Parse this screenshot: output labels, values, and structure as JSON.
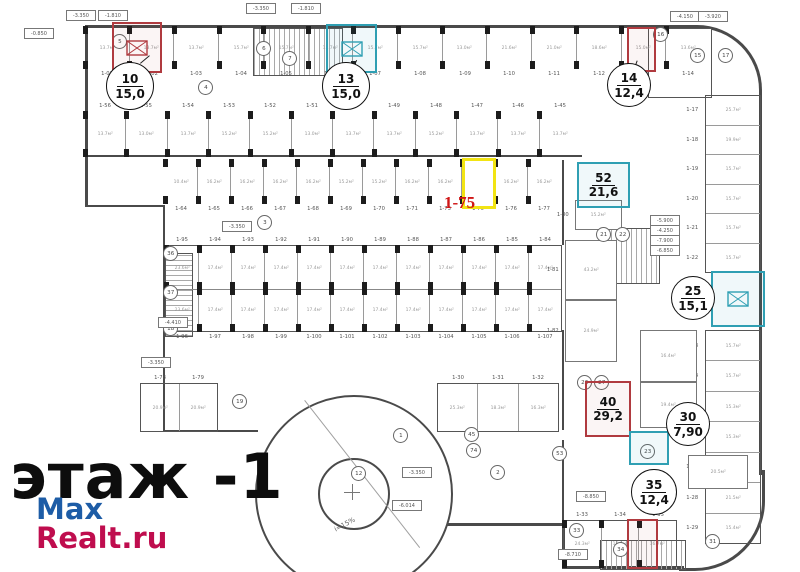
{
  "floor_label": "этаж -1",
  "watermark": {
    "line1": "Max",
    "line2": "Realt.ru",
    "color1": "#1d5ca6",
    "color2": "#bf0d4e"
  },
  "selected_unit": {
    "code": "1-75",
    "highlight_color": "#f2e413",
    "label_color": "#d01616"
  },
  "badges": {
    "u10": {
      "num": "10",
      "area": "15,0",
      "accent": "#b03a3f"
    },
    "u13": {
      "num": "13",
      "area": "15,0",
      "accent": "#2f9fb3"
    },
    "u14": {
      "num": "14",
      "area": "12,4",
      "accent": "#b03a3f"
    },
    "u52": {
      "num": "52",
      "area": "21,6",
      "accent": "#2f9fb3"
    },
    "u25": {
      "num": "25",
      "area": "15,1",
      "accent": "#2f9fb3"
    },
    "u40": {
      "num": "40",
      "area": "29,2",
      "accent": "#b03a3f"
    },
    "u30": {
      "num": "30",
      "area": "7,90",
      "accent": "#2f9fb3"
    },
    "u35": {
      "num": "35",
      "area": "12,4",
      "accent": "#b03a3f"
    }
  },
  "rows": {
    "rowA": [
      {
        "n": "1-01",
        "a": "13.7м²"
      },
      {
        "n": "1-02",
        "a": "13.7м²"
      },
      {
        "n": "1-03",
        "a": "13.7м²"
      },
      {
        "n": "1-04",
        "a": "15.7м²"
      },
      {
        "n": "1-05",
        "a": "15.7м²"
      },
      {
        "n": "1-06",
        "a": "15.7м²"
      },
      {
        "n": "1-07",
        "a": "15.7м²"
      },
      {
        "n": "1-08",
        "a": "15.7м²"
      },
      {
        "n": "1-09",
        "a": "13.0м²"
      },
      {
        "n": "1-10",
        "a": "21.6м²"
      },
      {
        "n": "1-11",
        "a": "21.0м²"
      },
      {
        "n": "1-12",
        "a": "18.6м²"
      },
      {
        "n": "1-13",
        "a": "15.0м²"
      },
      {
        "n": "1-14",
        "a": "13.6м²"
      }
    ],
    "rowB": [
      {
        "n": "1-56",
        "a": "13.7м²"
      },
      {
        "n": "1-55",
        "a": "13.0м²"
      },
      {
        "n": "1-54",
        "a": "13.7м²"
      },
      {
        "n": "1-53",
        "a": "15.2м²"
      },
      {
        "n": "1-52",
        "a": "15.2м²"
      },
      {
        "n": "1-51",
        "a": "13.0м²"
      },
      {
        "n": "1-50",
        "a": "13.7м²"
      },
      {
        "n": "1-49",
        "a": "13.7м²"
      },
      {
        "n": "1-48",
        "a": "15.2м²"
      },
      {
        "n": "1-47",
        "a": "13.7м²"
      },
      {
        "n": "1-46",
        "a": "13.7м²"
      },
      {
        "n": "1-45",
        "a": "13.7м²"
      }
    ],
    "rowC": [
      {
        "n": "1-64",
        "a": "10.4м²"
      },
      {
        "n": "1-65",
        "a": "16.2м²"
      },
      {
        "n": "1-66",
        "a": "16.2м²"
      },
      {
        "n": "1-67",
        "a": "16.2м²"
      },
      {
        "n": "1-68",
        "a": "16.2м²"
      },
      {
        "n": "1-69",
        "a": "15.2м²"
      },
      {
        "n": "1-70",
        "a": "15.2м²"
      },
      {
        "n": "1-71",
        "a": "16.2м²"
      },
      {
        "n": "1-73",
        "a": "16.2м²"
      },
      {
        "n": "1-75",
        "a": ""
      },
      {
        "n": "1-76",
        "a": "16.2м²"
      },
      {
        "n": "1-77",
        "a": "16.2м²"
      }
    ],
    "centralTop": [
      {
        "n": "1-95",
        "a": "23.6м²"
      },
      {
        "n": "1-94",
        "a": "17.4м²"
      },
      {
        "n": "1-93",
        "a": "17.4м²"
      },
      {
        "n": "1-92",
        "a": "17.4м²"
      },
      {
        "n": "1-91",
        "a": "17.4м²"
      },
      {
        "n": "1-90",
        "a": "17.4м²"
      },
      {
        "n": "1-89",
        "a": "17.4м²"
      },
      {
        "n": "1-88",
        "a": "17.4м²"
      },
      {
        "n": "1-87",
        "a": "17.4м²"
      },
      {
        "n": "1-86",
        "a": "17.4м²"
      },
      {
        "n": "1-85",
        "a": "17.4м²"
      },
      {
        "n": "1-84",
        "a": "17.4м²"
      }
    ],
    "centralBottom": [
      {
        "n": "1-96",
        "a": "23.6м²"
      },
      {
        "n": "1-97",
        "a": "17.4м²"
      },
      {
        "n": "1-98",
        "a": "17.4м²"
      },
      {
        "n": "1-99",
        "a": "17.4м²"
      },
      {
        "n": "1-100",
        "a": "17.4м²"
      },
      {
        "n": "1-101",
        "a": "17.4м²"
      },
      {
        "n": "1-102",
        "a": "17.4м²"
      },
      {
        "n": "1-103",
        "a": "17.4м²"
      },
      {
        "n": "1-104",
        "a": "17.4м²"
      },
      {
        "n": "1-105",
        "a": "17.4м²"
      },
      {
        "n": "1-106",
        "a": "17.4м²"
      },
      {
        "n": "1-107",
        "a": "17.4м²"
      }
    ],
    "rightUpper": [
      {
        "n": "1-17",
        "a": "25.7м²"
      },
      {
        "n": "1-18",
        "a": "19.9м²"
      },
      {
        "n": "1-19",
        "a": "15.7м²"
      },
      {
        "n": "1-20",
        "a": "15.7м²"
      },
      {
        "n": "1-21",
        "a": "15.7м²"
      },
      {
        "n": "1-22",
        "a": "15.7м²"
      }
    ],
    "rightLower": [
      {
        "n": "1-23",
        "a": "15.7м²"
      },
      {
        "n": "1-24",
        "a": "15.7м²"
      },
      {
        "n": "1-25",
        "a": "15.3м²"
      },
      {
        "n": "1-26",
        "a": "15.3м²"
      },
      {
        "n": "1-27",
        "a": "15.3м²"
      },
      {
        "n": "1-28",
        "a": "21.5м²"
      },
      {
        "n": "1-29",
        "a": "15.4м²"
      }
    ],
    "bottomRow": [
      {
        "n": "1-33",
        "a": "24.3м²"
      },
      {
        "n": "1-34",
        "a": "15.9м²"
      },
      {
        "n": "1-35",
        "a": "16.7м²"
      }
    ],
    "leftPair": [
      {
        "n": "1-78",
        "a": "20.9м²"
      },
      {
        "n": "1-79",
        "a": "20.9м²"
      }
    ],
    "circleTopRow": [
      {
        "n": "1-30",
        "a": "25.3м²"
      },
      {
        "n": "1-31",
        "a": "18.3м²"
      },
      {
        "n": "1-32",
        "a": "16.3м²"
      }
    ]
  },
  "misc_rooms": [
    {
      "n": "1-80",
      "a": "15.2м²"
    },
    {
      "n": "1-81",
      "a": "43.2м²"
    },
    {
      "n": "1-82",
      "a": "24.9м²"
    },
    {
      "n": "",
      "a": "16.4м²"
    },
    {
      "n": "",
      "a": "19.4м²"
    },
    {
      "n": "",
      "a": "14.4м²"
    },
    {
      "n": "",
      "a": "20.5м²"
    }
  ],
  "circles": [
    {
      "n": "5",
      "x": 118,
      "y": 40
    },
    {
      "n": "6",
      "x": 262,
      "y": 47
    },
    {
      "n": "7",
      "x": 288,
      "y": 57
    },
    {
      "n": "4",
      "x": 204,
      "y": 86
    },
    {
      "n": "3",
      "x": 263,
      "y": 221
    },
    {
      "n": "36",
      "x": 169,
      "y": 252
    },
    {
      "n": "37",
      "x": 169,
      "y": 291
    },
    {
      "n": "18",
      "x": 169,
      "y": 327
    },
    {
      "n": "19",
      "x": 238,
      "y": 400
    },
    {
      "n": "1",
      "x": 399,
      "y": 434
    },
    {
      "n": "12",
      "x": 357,
      "y": 472
    },
    {
      "n": "2",
      "x": 496,
      "y": 471
    },
    {
      "n": "45",
      "x": 470,
      "y": 433
    },
    {
      "n": "74",
      "x": 472,
      "y": 449
    },
    {
      "n": "53",
      "x": 558,
      "y": 452
    },
    {
      "n": "21",
      "x": 602,
      "y": 233
    },
    {
      "n": "22",
      "x": 621,
      "y": 233
    },
    {
      "n": "26",
      "x": 583,
      "y": 381
    },
    {
      "n": "27",
      "x": 600,
      "y": 381
    },
    {
      "n": "23",
      "x": 646,
      "y": 450
    },
    {
      "n": "16",
      "x": 659,
      "y": 33
    },
    {
      "n": "15",
      "x": 696,
      "y": 54
    },
    {
      "n": "17",
      "x": 724,
      "y": 54
    },
    {
      "n": "31",
      "x": 711,
      "y": 540
    },
    {
      "n": "33",
      "x": 575,
      "y": 529
    },
    {
      "n": "34",
      "x": 619,
      "y": 548
    }
  ],
  "levels": [
    {
      "v": "-0.850",
      "x": 24,
      "y": 28
    },
    {
      "v": "-3.350",
      "x": 66,
      "y": 10
    },
    {
      "v": "-1.810",
      "x": 98,
      "y": 10
    },
    {
      "v": "-3.350",
      "x": 246,
      "y": 3
    },
    {
      "v": "-1.810",
      "x": 291,
      "y": 3
    },
    {
      "v": "-3.350",
      "x": 222,
      "y": 221
    },
    {
      "v": "-3.350",
      "x": 141,
      "y": 357
    },
    {
      "v": "-3.350",
      "x": 402,
      "y": 467
    },
    {
      "v": "-6.014",
      "x": 392,
      "y": 500
    },
    {
      "v": "-5.900",
      "x": 650,
      "y": 215
    },
    {
      "v": "-4.250",
      "x": 650,
      "y": 225
    },
    {
      "v": "-7.900",
      "x": 650,
      "y": 235
    },
    {
      "v": "-6.850",
      "x": 650,
      "y": 245
    },
    {
      "v": "-4.150",
      "x": 670,
      "y": 11
    },
    {
      "v": "-3.920",
      "x": 698,
      "y": 11
    },
    {
      "v": "-8.850",
      "x": 576,
      "y": 491
    },
    {
      "v": "-8.710",
      "x": 558,
      "y": 549
    },
    {
      "v": "-4.410",
      "x": 158,
      "y": 317
    }
  ],
  "ramp": {
    "slope_label": "i=15%"
  }
}
